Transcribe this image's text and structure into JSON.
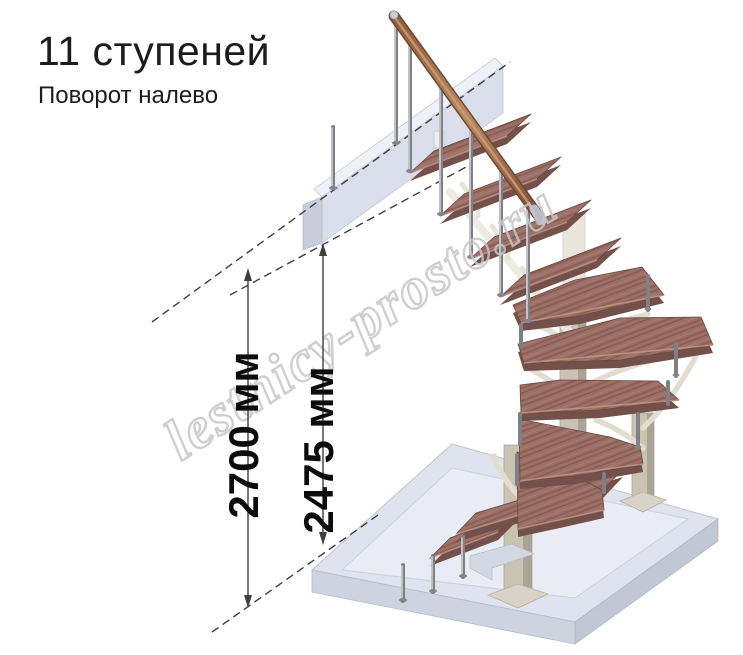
{
  "header": {
    "title": "11 ступеней",
    "subtitle": "Поворот налево"
  },
  "dimensions": {
    "overall_height": "2700 мм",
    "ceiling_height": "2475 мм"
  },
  "watermark": {
    "text": "lestnicy-prosto.ru"
  },
  "colors": {
    "wood": "#9c7066",
    "wood_edge": "#73504a",
    "handrail": "#a9744f",
    "metal_rod": "#8a8a90",
    "column_beige": "#c9c3b3",
    "bracket_cream": "#e9e6db",
    "floor_top": "#dfe3ee",
    "floor_side": "#c6cbd9",
    "dimension_line": "#3f3f3f",
    "watermark_outline": "#c7c7c7",
    "text": "#1c1c1c"
  }
}
